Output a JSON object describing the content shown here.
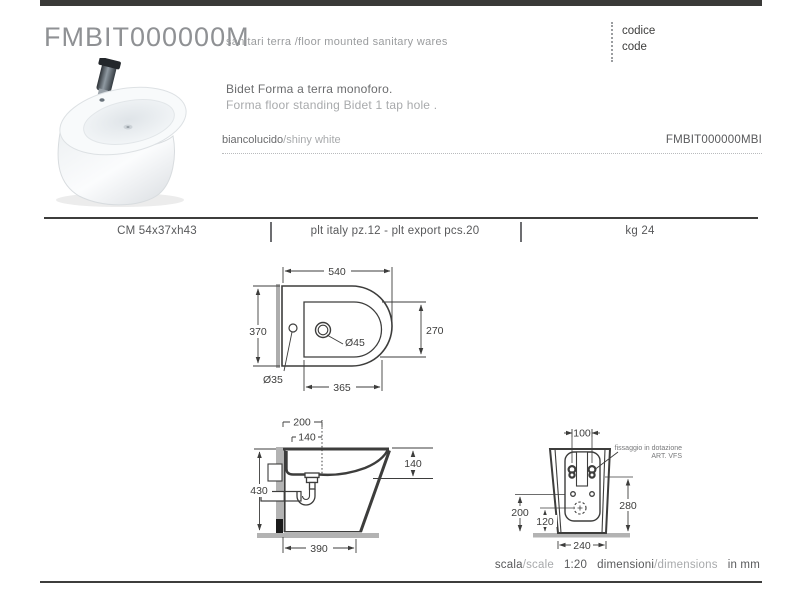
{
  "header": {
    "product_code": "FMBIT000000M",
    "category": "sanitari terra /floor mounted sanitary wares",
    "code_label_it": "codice",
    "code_label_en": "code"
  },
  "product": {
    "description_it": "Bidet Forma a terra monoforo.",
    "description_en": "Forma floor standing Bidet 1 tap hole .",
    "finish_it": "biancolucido",
    "finish_en": "/shiny white",
    "variant_code": "FMBIT000000MBI"
  },
  "specs": {
    "size_cm": "CM  54x37xh43",
    "pallet": "plt italy pz.12  - plt export pcs.20",
    "weight": "kg 24"
  },
  "drawings": {
    "plan_view": {
      "width": "540",
      "depth": "370",
      "basin_depth": "270",
      "basin_length": "365",
      "tap_hole_dia": "Ø45",
      "rear_hole_dia": "Ø35"
    },
    "side_view": {
      "wall_to_tap": "200",
      "wall_to_hole": "140",
      "height": "430",
      "rim_to_outlet": "140",
      "base_depth": "390"
    },
    "back_view": {
      "fixing_span": "100",
      "note_line1": "fissaggio in dotazione",
      "note_line2": "ART. VFS",
      "inlet_height": "200",
      "drain_height": "120",
      "fixing_height": "280",
      "base_width": "240"
    }
  },
  "footer": {
    "scale_it": "scala",
    "scale_en": "/scale",
    "scale_value": "1:20",
    "dimensions_it": "dimensioni",
    "dimensions_en": "/dimensions",
    "unit": "in mm"
  },
  "colors": {
    "line_dark": "#3d3d3c",
    "text_gray": "#6b6c6e",
    "text_light": "#a8aaac",
    "wall_gray": "#b3b3b3"
  }
}
